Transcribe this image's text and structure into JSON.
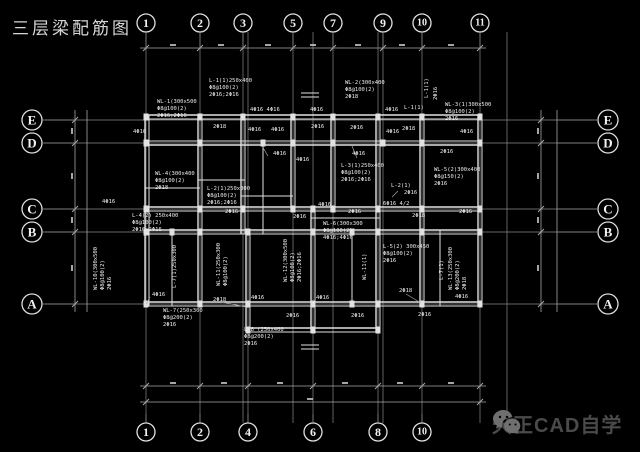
{
  "title": "三层梁配筋图",
  "watermark": {
    "text": "天正CAD自学",
    "icon": "wechat-icon",
    "text_color": "#4a4a4a",
    "icon_color": "#6f6f6f"
  },
  "colors": {
    "background": "#000000",
    "beam_line": "#e2e2e2",
    "grid_line": "#8a8a8a",
    "dim_line": "#a8a8a8",
    "annotation_text": "#ececec",
    "bubble_stroke": "#e0e0e0",
    "bubble_text": "#f2f2f2"
  },
  "axes": {
    "top": [
      {
        "label": "1",
        "x": 146
      },
      {
        "label": "2",
        "x": 200
      },
      {
        "label": "3",
        "x": 243
      },
      {
        "label": "5",
        "x": 293
      },
      {
        "label": "7",
        "x": 333
      },
      {
        "label": "9",
        "x": 383
      },
      {
        "label": "10",
        "x": 422
      },
      {
        "label": "11",
        "x": 480
      }
    ],
    "bottom": [
      {
        "label": "1",
        "x": 146
      },
      {
        "label": "2",
        "x": 200
      },
      {
        "label": "4",
        "x": 248
      },
      {
        "label": "6",
        "x": 313
      },
      {
        "label": "8",
        "x": 378
      },
      {
        "label": "10",
        "x": 422
      }
    ],
    "left": [
      {
        "label": "E",
        "y": 120
      },
      {
        "label": "D",
        "y": 143
      },
      {
        "label": "C",
        "y": 209
      },
      {
        "label": "B",
        "y": 232
      },
      {
        "label": "A",
        "y": 304
      }
    ],
    "right": [
      {
        "label": "E",
        "y": 120
      },
      {
        "label": "D",
        "y": 143
      },
      {
        "label": "C",
        "y": 209
      },
      {
        "label": "B",
        "y": 232
      },
      {
        "label": "A",
        "y": 304
      }
    ]
  },
  "drawing": {
    "grid_v": [
      146,
      200,
      243,
      248,
      293,
      313,
      333,
      378,
      383,
      422,
      480,
      507
    ],
    "grid_h": [
      120,
      143,
      209,
      232,
      304
    ],
    "beams": [
      [
        145,
        115,
        482,
        115,
        1.4
      ],
      [
        145,
        119,
        482,
        119,
        1
      ],
      [
        145,
        141,
        482,
        141,
        1
      ],
      [
        145,
        145,
        482,
        145,
        1.4
      ],
      [
        145,
        207,
        482,
        207,
        1.4
      ],
      [
        145,
        211,
        482,
        211,
        1
      ],
      [
        145,
        230,
        482,
        230,
        1.4
      ],
      [
        145,
        234,
        482,
        234,
        1
      ],
      [
        145,
        302,
        482,
        302,
        1.4
      ],
      [
        145,
        306,
        482,
        306,
        1
      ],
      [
        246,
        328,
        380,
        328,
        1.4
      ],
      [
        246,
        332,
        380,
        332,
        1
      ],
      [
        198,
        180,
        245,
        180,
        1
      ],
      [
        145,
        188,
        200,
        188,
        1
      ],
      [
        241,
        196,
        293,
        196,
        1
      ],
      [
        311,
        218,
        380,
        218,
        1
      ],
      [
        145,
        115,
        145,
        306,
        1.4
      ],
      [
        149,
        115,
        149,
        306,
        1
      ],
      [
        198,
        115,
        198,
        306,
        1.4
      ],
      [
        202,
        115,
        202,
        306,
        1
      ],
      [
        241,
        115,
        241,
        234,
        1.4
      ],
      [
        245,
        115,
        245,
        234,
        1
      ],
      [
        246,
        230,
        246,
        332,
        1.4
      ],
      [
        250,
        230,
        250,
        332,
        1
      ],
      [
        291,
        115,
        291,
        211,
        1.4
      ],
      [
        295,
        115,
        295,
        211,
        1
      ],
      [
        311,
        207,
        311,
        332,
        1.4
      ],
      [
        315,
        207,
        315,
        332,
        1
      ],
      [
        331,
        115,
        331,
        211,
        1.4
      ],
      [
        335,
        115,
        335,
        211,
        1
      ],
      [
        376,
        115,
        376,
        332,
        1.4
      ],
      [
        380,
        115,
        380,
        332,
        1
      ],
      [
        420,
        115,
        420,
        306,
        1.4
      ],
      [
        424,
        115,
        424,
        306,
        1
      ],
      [
        478,
        115,
        478,
        306,
        1.4
      ],
      [
        482,
        115,
        482,
        306,
        1
      ],
      [
        172,
        230,
        172,
        306,
        1
      ],
      [
        263,
        141,
        263,
        234,
        1
      ],
      [
        352,
        230,
        352,
        306,
        1
      ],
      [
        440,
        230,
        440,
        306,
        1
      ]
    ],
    "columns": [
      [
        146,
        117
      ],
      [
        200,
        117
      ],
      [
        243,
        117
      ],
      [
        293,
        117
      ],
      [
        333,
        117
      ],
      [
        378,
        117
      ],
      [
        422,
        117
      ],
      [
        480,
        117
      ],
      [
        146,
        143
      ],
      [
        200,
        143
      ],
      [
        263,
        143
      ],
      [
        293,
        143
      ],
      [
        333,
        143
      ],
      [
        383,
        143
      ],
      [
        422,
        143
      ],
      [
        480,
        143
      ],
      [
        146,
        209
      ],
      [
        200,
        209
      ],
      [
        243,
        209
      ],
      [
        293,
        209
      ],
      [
        313,
        209
      ],
      [
        333,
        209
      ],
      [
        378,
        209
      ],
      [
        422,
        209
      ],
      [
        480,
        209
      ],
      [
        146,
        232
      ],
      [
        172,
        232
      ],
      [
        200,
        232
      ],
      [
        248,
        232
      ],
      [
        313,
        232
      ],
      [
        352,
        232
      ],
      [
        378,
        232
      ],
      [
        422,
        232
      ],
      [
        480,
        232
      ],
      [
        146,
        304
      ],
      [
        200,
        304
      ],
      [
        248,
        304
      ],
      [
        313,
        304
      ],
      [
        352,
        304
      ],
      [
        378,
        304
      ],
      [
        422,
        304
      ],
      [
        480,
        304
      ],
      [
        248,
        330
      ],
      [
        313,
        330
      ],
      [
        378,
        330
      ]
    ],
    "annotations": [
      {
        "x": 157,
        "y": 103,
        "t": "WL-1(300x500"
      },
      {
        "x": 157,
        "y": 110,
        "t": "Φ8@100(2)"
      },
      {
        "x": 157,
        "y": 117,
        "t": "2Φ16;2Φ16"
      },
      {
        "x": 209,
        "y": 82,
        "t": "L-1(1)250x400"
      },
      {
        "x": 209,
        "y": 89,
        "t": "Φ8@100(2)"
      },
      {
        "x": 209,
        "y": 96,
        "t": "2Φ16;2Φ16"
      },
      {
        "x": 345,
        "y": 84,
        "t": "WL-2(300x400"
      },
      {
        "x": 345,
        "y": 91,
        "t": "Φ8@100(2)"
      },
      {
        "x": 345,
        "y": 98,
        "t": "2Φ18"
      },
      {
        "x": 445,
        "y": 106,
        "t": "WL-3(1)300x500"
      },
      {
        "x": 445,
        "y": 113,
        "t": "Φ8@100(2)"
      },
      {
        "x": 445,
        "y": 120,
        "t": "2Φ16"
      },
      {
        "x": 250,
        "y": 111,
        "t": "4Φ16 4Φ16"
      },
      {
        "x": 310,
        "y": 111,
        "t": "4Φ16"
      },
      {
        "x": 385,
        "y": 111,
        "t": "4Φ16"
      },
      {
        "x": 404,
        "y": 109,
        "t": "L-1(1)"
      },
      {
        "x": 428,
        "y": 98,
        "t": "L-1(1)",
        "r": -90
      },
      {
        "x": 437,
        "y": 100,
        "t": "2Φ16",
        "r": -90
      },
      {
        "x": 133,
        "y": 133,
        "t": "4Φ16"
      },
      {
        "x": 213,
        "y": 128,
        "t": "2Φ18"
      },
      {
        "x": 248,
        "y": 131,
        "t": "4Φ16"
      },
      {
        "x": 271,
        "y": 131,
        "t": "4Φ16"
      },
      {
        "x": 311,
        "y": 128,
        "t": "2Φ16"
      },
      {
        "x": 350,
        "y": 129,
        "t": "2Φ16"
      },
      {
        "x": 386,
        "y": 133,
        "t": "4Φ16"
      },
      {
        "x": 402,
        "y": 130,
        "t": "2Φ18"
      },
      {
        "x": 460,
        "y": 133,
        "t": "4Φ16"
      },
      {
        "x": 440,
        "y": 153,
        "t": "2Φ16"
      },
      {
        "x": 273,
        "y": 155,
        "t": "4Φ16"
      },
      {
        "x": 352,
        "y": 155,
        "t": "4Φ16"
      },
      {
        "x": 155,
        "y": 175,
        "t": "WL-4(300x400"
      },
      {
        "x": 155,
        "y": 182,
        "t": "Φ8@100(2)"
      },
      {
        "x": 155,
        "y": 189,
        "t": "2Φ18"
      },
      {
        "x": 207,
        "y": 190,
        "t": "L-2(1)250x300"
      },
      {
        "x": 207,
        "y": 197,
        "t": "Φ8@100(2)"
      },
      {
        "x": 207,
        "y": 204,
        "t": "2Φ16;2Φ16"
      },
      {
        "x": 341,
        "y": 167,
        "t": "L-3(1)250x400"
      },
      {
        "x": 341,
        "y": 174,
        "t": "Φ8@100(2)"
      },
      {
        "x": 341,
        "y": 181,
        "t": "2Φ16;2Φ16"
      },
      {
        "x": 434,
        "y": 171,
        "t": "WL-5(2)300x400"
      },
      {
        "x": 434,
        "y": 178,
        "t": "Φ8@150(2)"
      },
      {
        "x": 434,
        "y": 185,
        "t": "2Φ16"
      },
      {
        "x": 391,
        "y": 187,
        "t": "L-2(1)"
      },
      {
        "x": 404,
        "y": 194,
        "t": "2Φ16"
      },
      {
        "x": 383,
        "y": 205,
        "t": "6Φ16 4/2"
      },
      {
        "x": 296,
        "y": 161,
        "t": "4Φ16"
      },
      {
        "x": 318,
        "y": 206,
        "t": "4Φ16"
      },
      {
        "x": 293,
        "y": 218,
        "t": "2Φ16"
      },
      {
        "x": 348,
        "y": 213,
        "t": "2Φ16"
      },
      {
        "x": 412,
        "y": 217,
        "t": "2Φ18"
      },
      {
        "x": 459,
        "y": 213,
        "t": "2Φ16"
      },
      {
        "x": 225,
        "y": 213,
        "t": "2Φ16"
      },
      {
        "x": 102,
        "y": 203,
        "t": "4Φ16"
      },
      {
        "x": 132,
        "y": 217,
        "t": "L-4(2) 250x400"
      },
      {
        "x": 132,
        "y": 224,
        "t": "Φ8@100(2)"
      },
      {
        "x": 132,
        "y": 231,
        "t": "2Φ16 2Φ16"
      },
      {
        "x": 97,
        "y": 290,
        "t": "WL-10(300x500",
        "r": -90
      },
      {
        "x": 104,
        "y": 290,
        "t": "Φ8@100(2)",
        "r": -90
      },
      {
        "x": 111,
        "y": 290,
        "t": "2Φ16",
        "r": -90
      },
      {
        "x": 176,
        "y": 288,
        "t": "L-7(1)250x300",
        "r": -90
      },
      {
        "x": 220,
        "y": 286,
        "t": "WL-11(250x300",
        "r": -90
      },
      {
        "x": 227,
        "y": 286,
        "t": "Φ8@100(2)",
        "r": -90
      },
      {
        "x": 287,
        "y": 282,
        "t": "WL-12(300x500",
        "r": -90
      },
      {
        "x": 294,
        "y": 282,
        "t": "Φ8@100(2)",
        "r": -90
      },
      {
        "x": 301,
        "y": 282,
        "t": "2Φ16;2Φ16",
        "r": -90
      },
      {
        "x": 366,
        "y": 280,
        "t": "WL-11(1)",
        "r": -90
      },
      {
        "x": 323,
        "y": 225,
        "t": "WL-6(300x300"
      },
      {
        "x": 323,
        "y": 232,
        "t": "Φ8@100(2)"
      },
      {
        "x": 323,
        "y": 239,
        "t": "4Φ16;4Φ16"
      },
      {
        "x": 383,
        "y": 248,
        "t": "L-5(2) 300x450"
      },
      {
        "x": 383,
        "y": 255,
        "t": "Φ8@100(2)"
      },
      {
        "x": 383,
        "y": 262,
        "t": "2Φ16"
      },
      {
        "x": 443,
        "y": 280,
        "t": "L-7(1)",
        "r": -90
      },
      {
        "x": 452,
        "y": 290,
        "t": "WL-13(250x300",
        "r": -90
      },
      {
        "x": 459,
        "y": 290,
        "t": "Φ8@200(2)",
        "r": -90
      },
      {
        "x": 466,
        "y": 290,
        "t": "2Φ18",
        "r": -90
      },
      {
        "x": 152,
        "y": 296,
        "t": "4Φ16"
      },
      {
        "x": 163,
        "y": 312,
        "t": "WL-7(250x300"
      },
      {
        "x": 163,
        "y": 319,
        "t": "Φ8@200(2)"
      },
      {
        "x": 163,
        "y": 326,
        "t": "2Φ16"
      },
      {
        "x": 213,
        "y": 301,
        "t": "2Φ18"
      },
      {
        "x": 251,
        "y": 299,
        "t": "4Φ16"
      },
      {
        "x": 286,
        "y": 317,
        "t": "2Φ16"
      },
      {
        "x": 316,
        "y": 299,
        "t": "4Φ16"
      },
      {
        "x": 351,
        "y": 317,
        "t": "2Φ16"
      },
      {
        "x": 399,
        "y": 292,
        "t": "2Φ18"
      },
      {
        "x": 455,
        "y": 298,
        "t": "4Φ16"
      },
      {
        "x": 418,
        "y": 316,
        "t": "2Φ16"
      },
      {
        "x": 244,
        "y": 331,
        "t": "L-8 (250x400"
      },
      {
        "x": 244,
        "y": 338,
        "t": "Φ8@200(2)"
      },
      {
        "x": 244,
        "y": 345,
        "t": "2Φ16"
      }
    ],
    "leaders": [
      [
        222,
        302,
        246,
        307
      ],
      [
        406,
        294,
        421,
        303
      ],
      [
        150,
        297,
        146,
        304
      ],
      [
        268,
        156,
        262,
        146
      ],
      [
        357,
        158,
        352,
        146
      ],
      [
        398,
        191,
        392,
        197
      ]
    ],
    "dims": {
      "top": {
        "y": 48,
        "x1": 140,
        "x2": 486,
        "ticks": [
          146,
          200,
          243,
          293,
          333,
          383,
          422,
          480
        ],
        "marks": [
          173,
          221,
          268,
          313,
          358,
          402,
          451
        ]
      },
      "bottom1": {
        "y": 386,
        "x1": 140,
        "x2": 486,
        "ticks": [
          146,
          200,
          248,
          313,
          378,
          422,
          480
        ],
        "marks": [
          173,
          224,
          280,
          345,
          400,
          451
        ]
      },
      "bottom2": {
        "y": 402,
        "x1": 140,
        "x2": 486,
        "ticks": [
          146,
          480
        ],
        "marks": [
          310
        ]
      },
      "left1": {
        "x": 75,
        "y1": 110,
        "y2": 312,
        "ticks": [
          120,
          143,
          209,
          232,
          304
        ],
        "marks": [
          131,
          176,
          220,
          268
        ]
      },
      "left2": {
        "x": 87,
        "y1": 110,
        "y2": 312,
        "ticks": [],
        "marks": []
      },
      "right1": {
        "x": 541,
        "y1": 110,
        "y2": 312,
        "ticks": [
          120,
          143,
          209,
          232,
          304
        ],
        "marks": [
          131,
          176,
          220,
          268
        ]
      },
      "right2": {
        "x": 557,
        "y1": 110,
        "y2": 312,
        "ticks": [],
        "marks": []
      }
    },
    "breaks": [
      [
        310,
        95
      ],
      [
        310,
        347
      ]
    ]
  }
}
